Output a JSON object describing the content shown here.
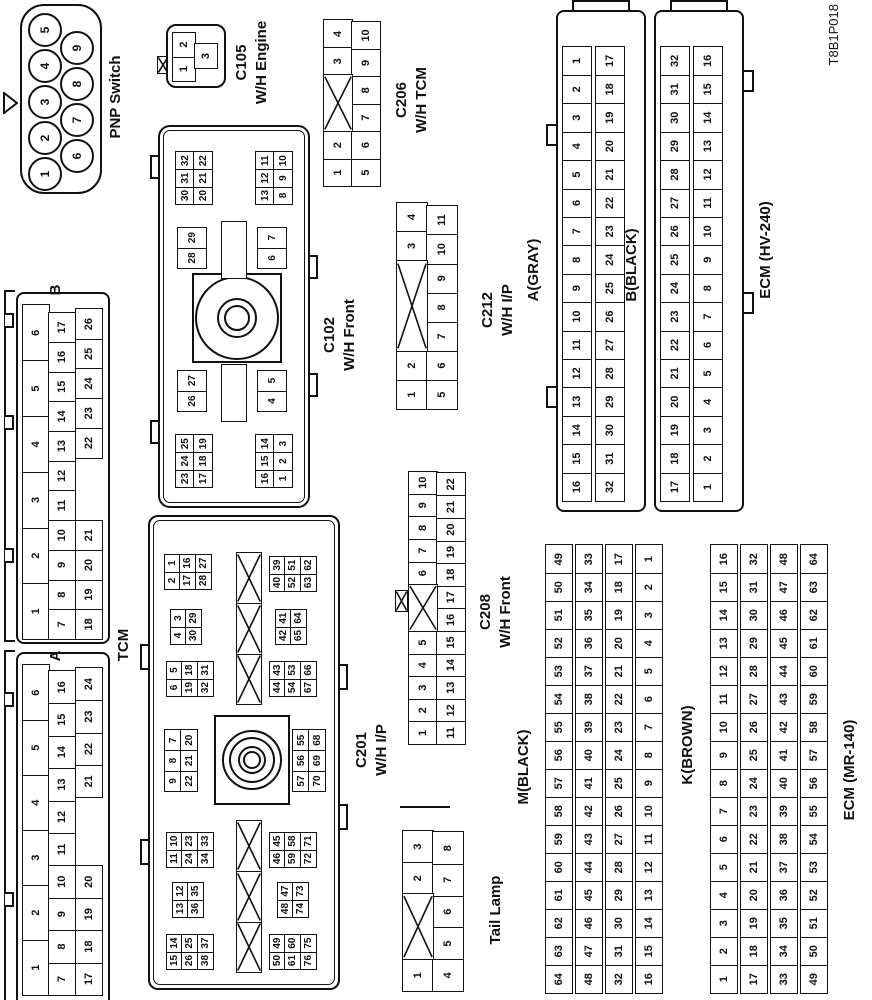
{
  "meta": {
    "code": "T8B1P018"
  },
  "labels": {
    "pnp": "PNP Switch",
    "c105": "C105\nW/H Engine",
    "c206": "C206\nW/H TCM",
    "c102": "C102\nW/H Front",
    "c201": "C201\nW/H I/P",
    "c212": "C212\nW/H I/P",
    "c208": "C208\nW/H Front",
    "tail": "Tail Lamp",
    "tcm": "TCM",
    "tcm_a": "A",
    "tcm_b": "B",
    "a_gray": "A(GRAY)",
    "b_black": "B(BLACK)",
    "ecm_hv": "ECM (HV-240)",
    "m_black": "M(BLACK)",
    "k_brown": "K(BROWN)",
    "ecm_mr": "ECM (MR-140)"
  },
  "pnp": {
    "row1": [
      "1",
      "2",
      "3",
      "4",
      "5"
    ],
    "row2": [
      "6",
      "7",
      "8",
      "9"
    ]
  },
  "c105": {
    "rows": [
      [
        "1",
        "2"
      ],
      [
        "_*0.5",
        "3"
      ]
    ]
  },
  "c206": {
    "rows": [
      [
        "1",
        "2",
        "X*2",
        "3",
        "4"
      ],
      [
        "5",
        "6",
        "7",
        "8",
        "9",
        "10"
      ]
    ]
  },
  "c212": {
    "rows": [
      [
        "1",
        "2",
        "X*3",
        "3",
        "4"
      ],
      [
        "5",
        "6",
        "7",
        "8",
        "9",
        "10",
        "11"
      ]
    ]
  },
  "c208": {
    "rows": [
      [
        "1",
        "2",
        "3",
        "4",
        "5",
        "X*2",
        "6",
        "7",
        "8",
        "9",
        "10"
      ],
      [
        "11",
        "12",
        "13",
        "14",
        "15",
        "16",
        "17",
        "18",
        "19",
        "20",
        "21",
        "22"
      ]
    ]
  },
  "tail": {
    "rows": [
      [
        "1",
        "X*2",
        "2",
        "3"
      ],
      [
        "4",
        "5",
        "6",
        "7",
        "8"
      ]
    ]
  },
  "tcm": {
    "a": {
      "rows": [
        [
          "1",
          "2",
          "3",
          "4",
          "5",
          "6"
        ],
        [
          "7",
          "8",
          "9",
          "10",
          "11",
          "12",
          "13",
          "14",
          "15",
          "16"
        ],
        [
          "17",
          "18",
          "19",
          "20",
          "_*2",
          "21",
          "22",
          "23",
          "24"
        ]
      ]
    },
    "b": {
      "rows": [
        [
          "1",
          "2",
          "3",
          "4",
          "5",
          "6"
        ],
        [
          "7",
          "8",
          "9",
          "10",
          "11",
          "12",
          "13",
          "14",
          "15",
          "16",
          "17"
        ],
        [
          "18",
          "19",
          "20",
          "21",
          "_*2",
          "22",
          "23",
          "24",
          "25",
          "26"
        ]
      ]
    }
  },
  "ecm_a": {
    "rows": [
      [
        "16",
        "15",
        "14",
        "13",
        "12",
        "11",
        "10",
        "9",
        "8",
        "7",
        "6",
        "5",
        "4",
        "3",
        "2",
        "1"
      ],
      [
        "32",
        "31",
        "30",
        "29",
        "28",
        "27",
        "26",
        "25",
        "24",
        "23",
        "22",
        "21",
        "20",
        "19",
        "18",
        "17"
      ]
    ]
  },
  "ecm_b": {
    "rows": [
      [
        "17",
        "18",
        "19",
        "20",
        "21",
        "22",
        "23",
        "24",
        "25",
        "26",
        "27",
        "28",
        "29",
        "30",
        "31",
        "32"
      ],
      [
        "1",
        "2",
        "3",
        "4",
        "5",
        "6",
        "7",
        "8",
        "9",
        "10",
        "11",
        "12",
        "13",
        "14",
        "15",
        "16"
      ]
    ]
  },
  "m": {
    "rows": [
      [
        "64",
        "63",
        "62",
        "61",
        "60",
        "59",
        "58",
        "57",
        "56",
        "55",
        "54",
        "53",
        "52",
        "51",
        "50",
        "49"
      ],
      [
        "48",
        "47",
        "46",
        "45",
        "44",
        "43",
        "42",
        "41",
        "40",
        "39",
        "38",
        "37",
        "36",
        "35",
        "34",
        "33"
      ],
      [
        "32",
        "31",
        "30",
        "29",
        "28",
        "27",
        "26",
        "25",
        "24",
        "23",
        "22",
        "21",
        "20",
        "19",
        "18",
        "17"
      ],
      [
        "16",
        "15",
        "14",
        "13",
        "12",
        "11",
        "10",
        "9",
        "8",
        "7",
        "6",
        "5",
        "4",
        "3",
        "2",
        "1"
      ]
    ]
  },
  "k": {
    "rows": [
      [
        "1",
        "2",
        "3",
        "4",
        "5",
        "6",
        "7",
        "8",
        "9",
        "10",
        "11",
        "12",
        "13",
        "14",
        "15",
        "16"
      ],
      [
        "17",
        "18",
        "19",
        "20",
        "21",
        "22",
        "23",
        "24",
        "25",
        "26",
        "27",
        "28",
        "29",
        "30",
        "31",
        "32"
      ],
      [
        "33",
        "34",
        "35",
        "36",
        "37",
        "38",
        "39",
        "40",
        "41",
        "42",
        "43",
        "44",
        "45",
        "46",
        "47",
        "48"
      ],
      [
        "49",
        "50",
        "51",
        "52",
        "53",
        "54",
        "55",
        "56",
        "57",
        "58",
        "59",
        "60",
        "61",
        "62",
        "63",
        "64"
      ]
    ]
  },
  "c102": {
    "blocks": {
      "tl": [
        [
          "23",
          "24",
          "25"
        ],
        [
          "17",
          "18",
          "19"
        ]
      ],
      "bl": [
        [
          "16",
          "15",
          "14"
        ],
        [
          "1",
          "2",
          "3"
        ]
      ],
      "l_top": [
        [
          "26",
          "27"
        ]
      ],
      "l_bot": [
        [
          "4",
          "5"
        ]
      ],
      "r_top": [
        [
          "28",
          "29"
        ]
      ],
      "r_bot": [
        [
          "6",
          "7"
        ]
      ],
      "tr": [
        [
          "30",
          "31",
          "32"
        ],
        [
          "20",
          "21",
          "22"
        ]
      ],
      "br": [
        [
          "13",
          "12",
          "11"
        ],
        [
          "8",
          "9",
          "10"
        ]
      ]
    }
  },
  "c201": {
    "blocks": {
      "t1": [
        [
          "15",
          "14"
        ],
        [
          "26",
          "25"
        ],
        [
          "38",
          "37"
        ]
      ],
      "t2": [
        [
          "13",
          "12"
        ],
        [
          "36",
          "35"
        ]
      ],
      "t3": [
        [
          "11",
          "10"
        ],
        [
          "24",
          "23"
        ],
        [
          "34",
          "33"
        ]
      ],
      "t4": [
        [
          "9",
          "8",
          "7"
        ],
        [
          "22",
          "21",
          "20"
        ]
      ],
      "t5": [
        [
          "6",
          "5"
        ],
        [
          "19",
          "18"
        ],
        [
          "32",
          "31"
        ]
      ],
      "t6": [
        [
          "4",
          "3"
        ],
        [
          "30",
          "29"
        ]
      ],
      "t7": [
        [
          "2",
          "1"
        ],
        [
          "17",
          "16"
        ],
        [
          "28",
          "27"
        ]
      ],
      "b1": [
        [
          "50",
          "49"
        ],
        [
          "61",
          "60"
        ],
        [
          "76",
          "75"
        ]
      ],
      "b2": [
        [
          "48",
          "47"
        ],
        [
          "74",
          "73"
        ]
      ],
      "b3": [
        [
          "46",
          "45"
        ],
        [
          "59",
          "58"
        ],
        [
          "72",
          "71"
        ]
      ],
      "b4": [
        [
          "57",
          "56",
          "55"
        ],
        [
          "70",
          "69",
          "68"
        ]
      ],
      "b5": [
        [
          "44",
          "43"
        ],
        [
          "54",
          "53"
        ],
        [
          "67",
          "66"
        ]
      ],
      "b6": [
        [
          "42",
          "41"
        ],
        [
          "65",
          "64"
        ]
      ],
      "b7": [
        [
          "40",
          "39"
        ],
        [
          "52",
          "51"
        ],
        [
          "63",
          "62"
        ]
      ],
      "x_left": [
        [
          "X",
          "X",
          "X"
        ]
      ],
      "x_right": [
        [
          "X",
          "X",
          "X"
        ]
      ]
    }
  }
}
